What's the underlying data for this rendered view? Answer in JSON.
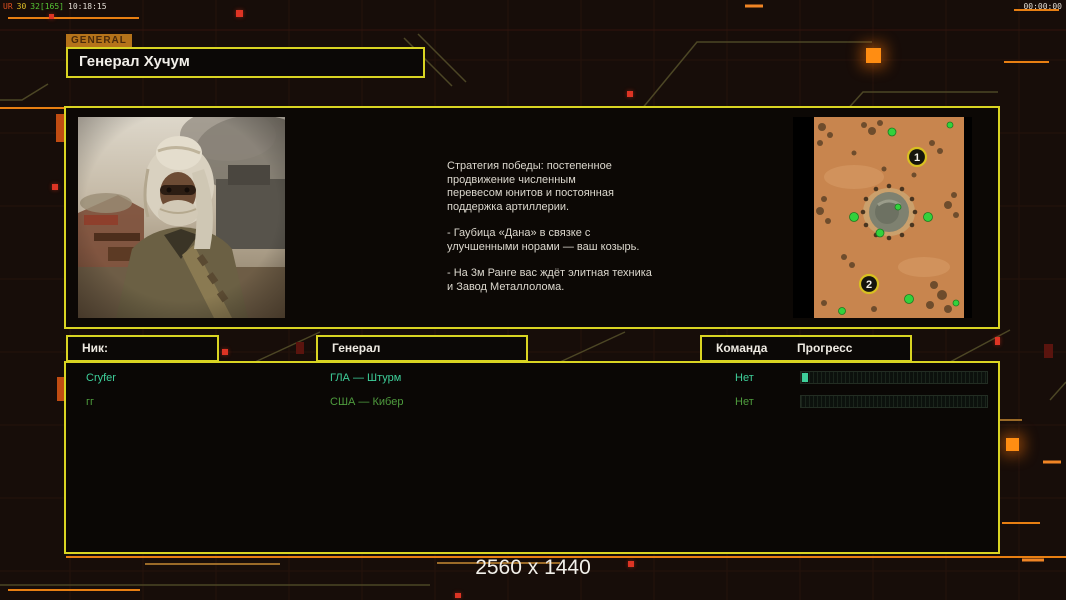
{
  "hud": {
    "perf_overlay": {
      "segments": [
        {
          "text": "UR",
          "color": "#e05020"
        },
        {
          "text": "30",
          "color": "#e0c028"
        },
        {
          "text": "32[165]",
          "color": "#55c535"
        },
        {
          "text": "10:18:15",
          "color": "#e2ddd4"
        }
      ]
    },
    "clock": "00:00:00"
  },
  "tab": {
    "label": "GENERAL"
  },
  "title": "Генерал Хучум",
  "briefing": {
    "paragraphs": [
      "Стратегия победы: постепенное\nпродвижение численным\nперевесом юнитов и постоянная\nподдержка артиллерии.",
      "- Гаубица «Дана» в связке с\nулучшенными норами — ваш козырь.",
      "- На 3м Ранге вас ждёт элитная техника\nи Завод Металлолома."
    ]
  },
  "minimap": {
    "markers": [
      "1",
      "2"
    ]
  },
  "table": {
    "headers": {
      "nick": "Ник:",
      "general": "Генерал",
      "team": "Команда",
      "progress": "Прогресс"
    },
    "rows": [
      {
        "nick": "Cryfer",
        "general": "ГЛА — Штурм",
        "team": "Нет",
        "progress_pct": 3,
        "color": "#3ecf9a"
      },
      {
        "nick": "гг",
        "general": "США — Кибер",
        "team": "Нет",
        "progress_pct": 0,
        "color": "#4f9c3e"
      }
    ]
  },
  "footer": {
    "resolution": "2560 x 1440"
  },
  "colors": {
    "accent_border": "#d9d422",
    "accent_orange": "#e87f12",
    "alert_red": "#dd3424"
  }
}
